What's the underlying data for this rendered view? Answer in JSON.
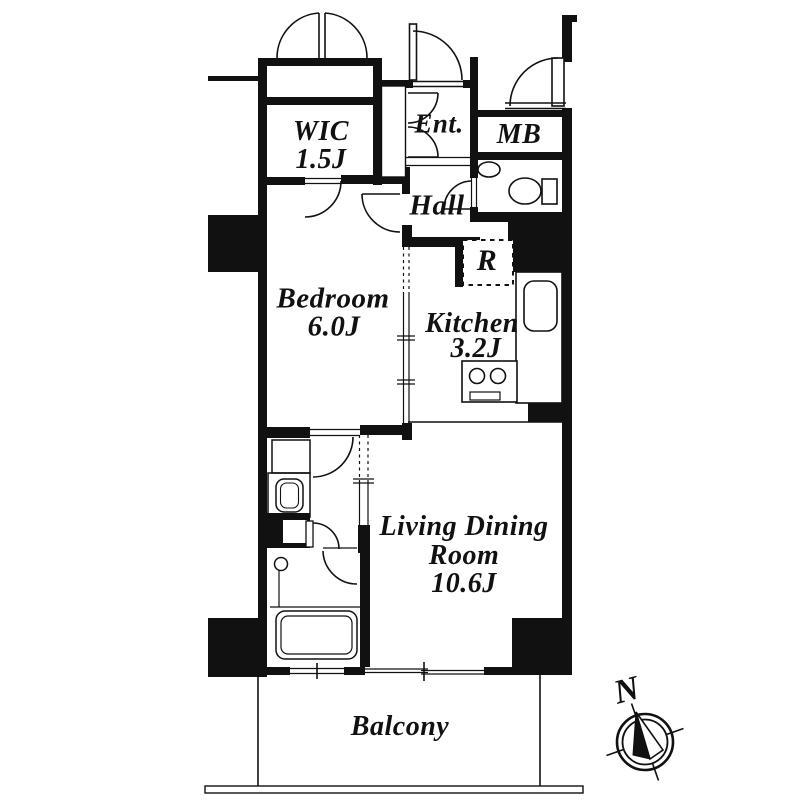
{
  "rooms": {
    "wic": {
      "name": "WIC",
      "size": "1.5J"
    },
    "entrance": {
      "name": "Ent."
    },
    "meter_box": {
      "name": "MB"
    },
    "hall": {
      "name": "Hall"
    },
    "bedroom": {
      "name": "Bedroom",
      "size": "6.0J"
    },
    "kitchen": {
      "name": "Kitchen",
      "size": "3.2J"
    },
    "refrigerator_space": {
      "name": "R"
    },
    "living_dining": {
      "line1": "Living Dining",
      "line2": "Room",
      "size": "10.6J"
    },
    "balcony": {
      "name": "Balcony"
    }
  },
  "compass": {
    "north_label": "N"
  },
  "fixtures": {
    "toilet": "toilet-icon",
    "hand_sink": "hand-sink-icon",
    "kitchen_sink": "kitchen-sink-icon",
    "stove": "stove-icon",
    "washbasin": "washbasin-icon",
    "washing_machine_pan": "washing-machine-pan-icon",
    "bathtub": "bathtub-icon",
    "shower_faucet": "shower-faucet-icon",
    "compass": "compass-icon"
  },
  "colors": {
    "wall": "#111111",
    "background": "#ffffff"
  }
}
